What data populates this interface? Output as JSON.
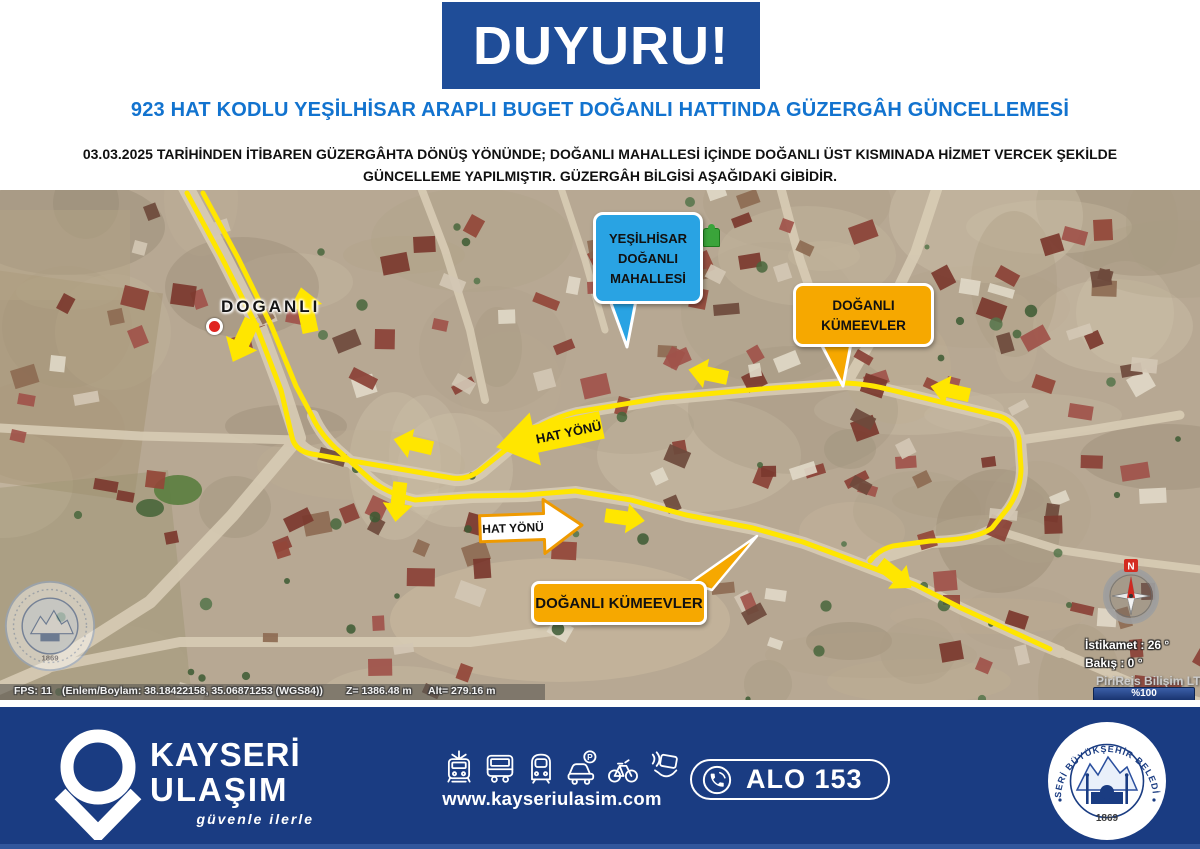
{
  "announcement": {
    "banner": "DUYURU!",
    "title": "923 HAT KODLU YEŞİLHİSAR ARAPLI BUGET DOĞANLI HATTINDA GÜZERGÂH GÜNCELLEMESİ",
    "body_line1": "03.03.2025 TARİHİNDEN İTİBAREN GÜZERGÂHTA DÖNÜŞ YÖNÜNDE; DOĞANLI MAHALLESİ İÇİNDE DOĞANLI ÜST KISMINADA HİZMET VERCEK ŞEKİLDE",
    "body_line2": "GÜNCELLEME YAPILMIŞTIR. GÜZERGÂH BİLGİSİ AŞAĞIDAKİ GİBİDİR."
  },
  "map": {
    "place_label": "DOGANLI",
    "callout_blue": {
      "lines": [
        "YEŞİLHİSAR",
        "DOĞANLI",
        "MAHALLESİ"
      ],
      "color": "#29a3e3"
    },
    "callout_orange_top": {
      "lines": [
        "DOĞANLI",
        "KÜMEEVLER"
      ],
      "color": "#f6a800"
    },
    "callout_orange_bottom": {
      "label": "DOĞANLI KÜMEEVLER",
      "color": "#f6a800"
    },
    "direction_upper": "HAT YÖNÜ",
    "direction_lower": "HAT YÖNÜ",
    "route_color": "#ffe600",
    "status_bar": {
      "fps": "FPS: 11",
      "coords": "(Enlem/Boylam: 38.18422158, 35.06871253 (WGS84))",
      "z": "Z= 1386.48 m",
      "alt": "Alt= 279.16 m"
    },
    "compass": {
      "north": "N",
      "heading": "İstikamet : 26 °",
      "view": "Bakış : 0 °",
      "vendor": "PiriReis Bilişim LTD",
      "zoom_level": "%100"
    },
    "watermark_year": "1869"
  },
  "footer": {
    "brand_line1": "KAYSERİ",
    "brand_line2": "ULAŞIM",
    "slogan": "güvenle ilerle",
    "website": "www.kayseriulasim.com",
    "hotline": "ALO 153",
    "parking_letter": "P",
    "icon_names": [
      "tram-icon",
      "bus-icon",
      "metro-icon",
      "car-parking-icon",
      "bicycle-icon",
      "contactless-card-icon"
    ],
    "seal": {
      "text": "KAYSERİ BÜYÜKŞEHİR BELEDİYESİ",
      "year": "1869"
    }
  },
  "colors": {
    "banner_blue": "#1f4d98",
    "title_blue": "#1273cf",
    "footer_navy": "#1a3c82",
    "route_yellow": "#ffe600",
    "callout_blue": "#29a3e3",
    "callout_orange": "#f6a800"
  }
}
